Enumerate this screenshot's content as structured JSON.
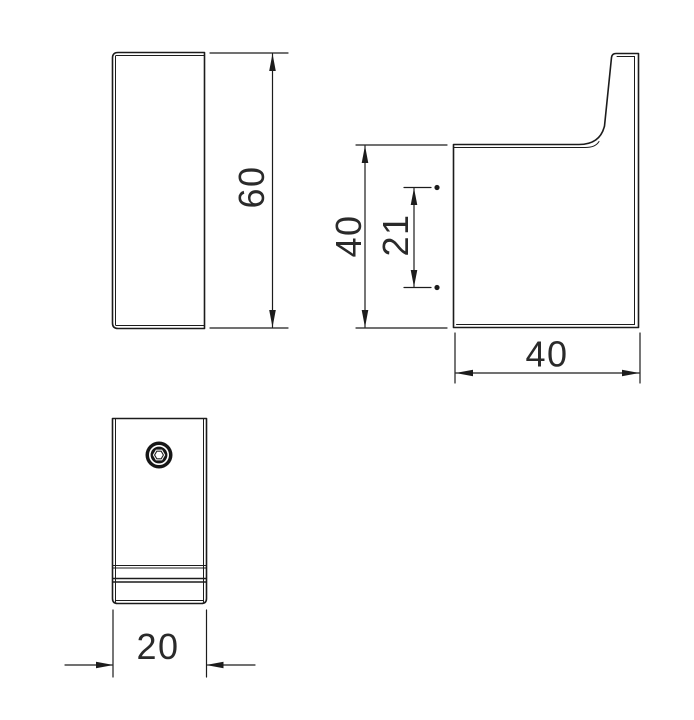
{
  "drawing": {
    "kind": "technical-drawing-orthographic-views",
    "subject": "wall-hook",
    "background_color": "#ffffff",
    "line_color": "#1c1c1c",
    "text_color": "#2a2a2a"
  },
  "icons": {
    "screw_head": "hex-socket-screw-head-icon"
  },
  "dimensions": {
    "flat_height": {
      "value": "60"
    },
    "side_height": {
      "value": "40"
    },
    "hole_offset": {
      "value": "21"
    },
    "side_depth": {
      "value": "40"
    },
    "front_width": {
      "value": "20"
    }
  }
}
